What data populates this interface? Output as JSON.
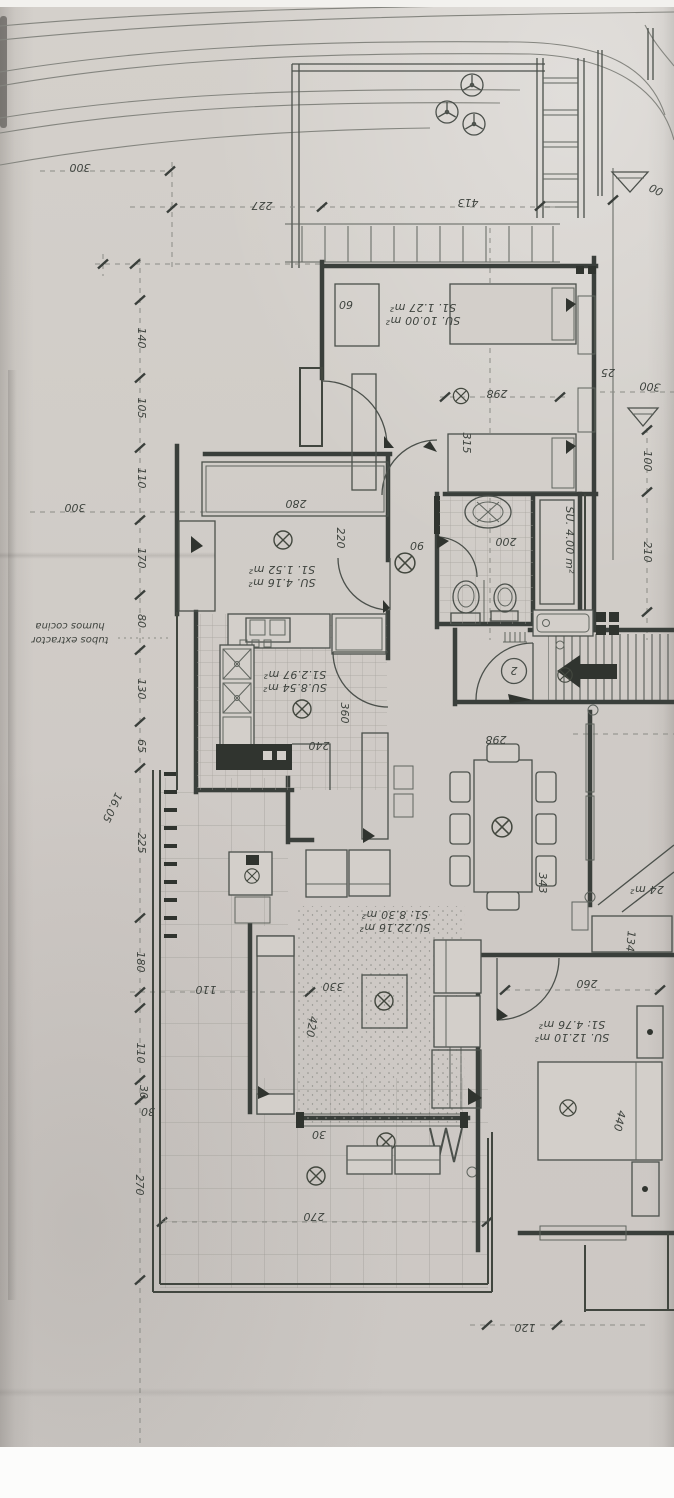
{
  "photo": {
    "type": "architectural floor plan, photographed paper, drawing appears rotated 180°",
    "paper_color": "#d1cdc8",
    "ink_color": "#3a3f3b",
    "pencil_color": "#84857f"
  },
  "plan": {
    "note": {
      "line1": "tubos extractor",
      "line2": "humos cocina"
    },
    "entry": {
      "number": "2"
    },
    "rooms": {
      "bedroom_top": {
        "su": "SU. 10.00 m²",
        "s1": "S1. 1.27 m²"
      },
      "dressing": {
        "su": "SU. 4.16 m²",
        "s1": "S1. 1.52 m²"
      },
      "bathroom": {
        "su": "SU. 4.00 m²"
      },
      "kitchen": {
        "su": "SU.8.54 m²",
        "s1": "S1.2.97 m²"
      },
      "living": {
        "su": "SU.22.16 m²",
        "s1": "S1: 8.30 m²"
      },
      "bedroom_bottom": {
        "su": "SU. 12.10 m²",
        "s1": "S1: 4.76 m²"
      },
      "partial_right": {
        "label": "24 m²"
      }
    },
    "dims": {
      "labels": [
        "300",
        "227",
        "413",
        "00",
        "140",
        "105",
        "110",
        "170",
        "80",
        "130",
        "65",
        "225",
        "180",
        "110",
        "30",
        "270",
        "16.05",
        "300",
        "25",
        "300",
        "100",
        "210",
        "60",
        "298",
        "315",
        "280",
        "220",
        "200",
        "90",
        "240",
        "360",
        "298",
        "343",
        "330",
        "420",
        "110",
        "30",
        "260",
        "440",
        "134",
        "270",
        "30",
        "120"
      ]
    },
    "symbols": [
      "tree-icon",
      "slope-triangle-icon",
      "ceiling-light-icon",
      "entry-arrow-icon",
      "door-swing-arc",
      "stair-ladder-icon"
    ]
  }
}
